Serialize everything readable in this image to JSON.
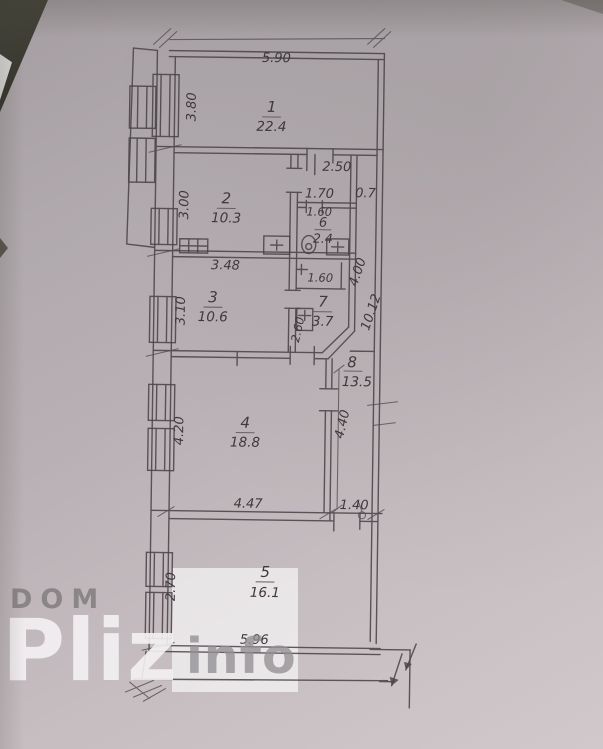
{
  "watermark": {
    "dom": "DOM",
    "pliz": "Pliz",
    "info": "info"
  },
  "rooms": [
    {
      "num": "1",
      "area": "22.4"
    },
    {
      "num": "2",
      "area": "10.3"
    },
    {
      "num": "3",
      "area": "10.6"
    },
    {
      "num": "4",
      "area": "18.8"
    },
    {
      "num": "5",
      "area": "16.1"
    },
    {
      "num": "6",
      "area": "2.4"
    },
    {
      "num": "7",
      "area": "3.7"
    },
    {
      "num": "8",
      "area": "13.5"
    }
  ],
  "dims": {
    "room1_top": "5.90",
    "room1_left": "3.80",
    "hall_top": "2.50",
    "room2_left": "3.00",
    "room2_bottom": "3.48",
    "wc_hall_top": "1.70",
    "shaft_area": "0.7",
    "wc_width": "1.60",
    "niche_width": "1.60",
    "right_upper": "4.00",
    "right_total": "10.12",
    "room3_left": "3.10",
    "room7_left": "2.60",
    "room4_left": "4.20",
    "room4_right": "4.40",
    "room4_bottom": "4.47",
    "corridor_bottom": "1.40",
    "room5_left": "2.70",
    "room5_bottom": "5.96"
  },
  "colors": {
    "paper": "#b8b0b4",
    "ink": "#4b4449",
    "background_corner": "#3e3d33"
  }
}
